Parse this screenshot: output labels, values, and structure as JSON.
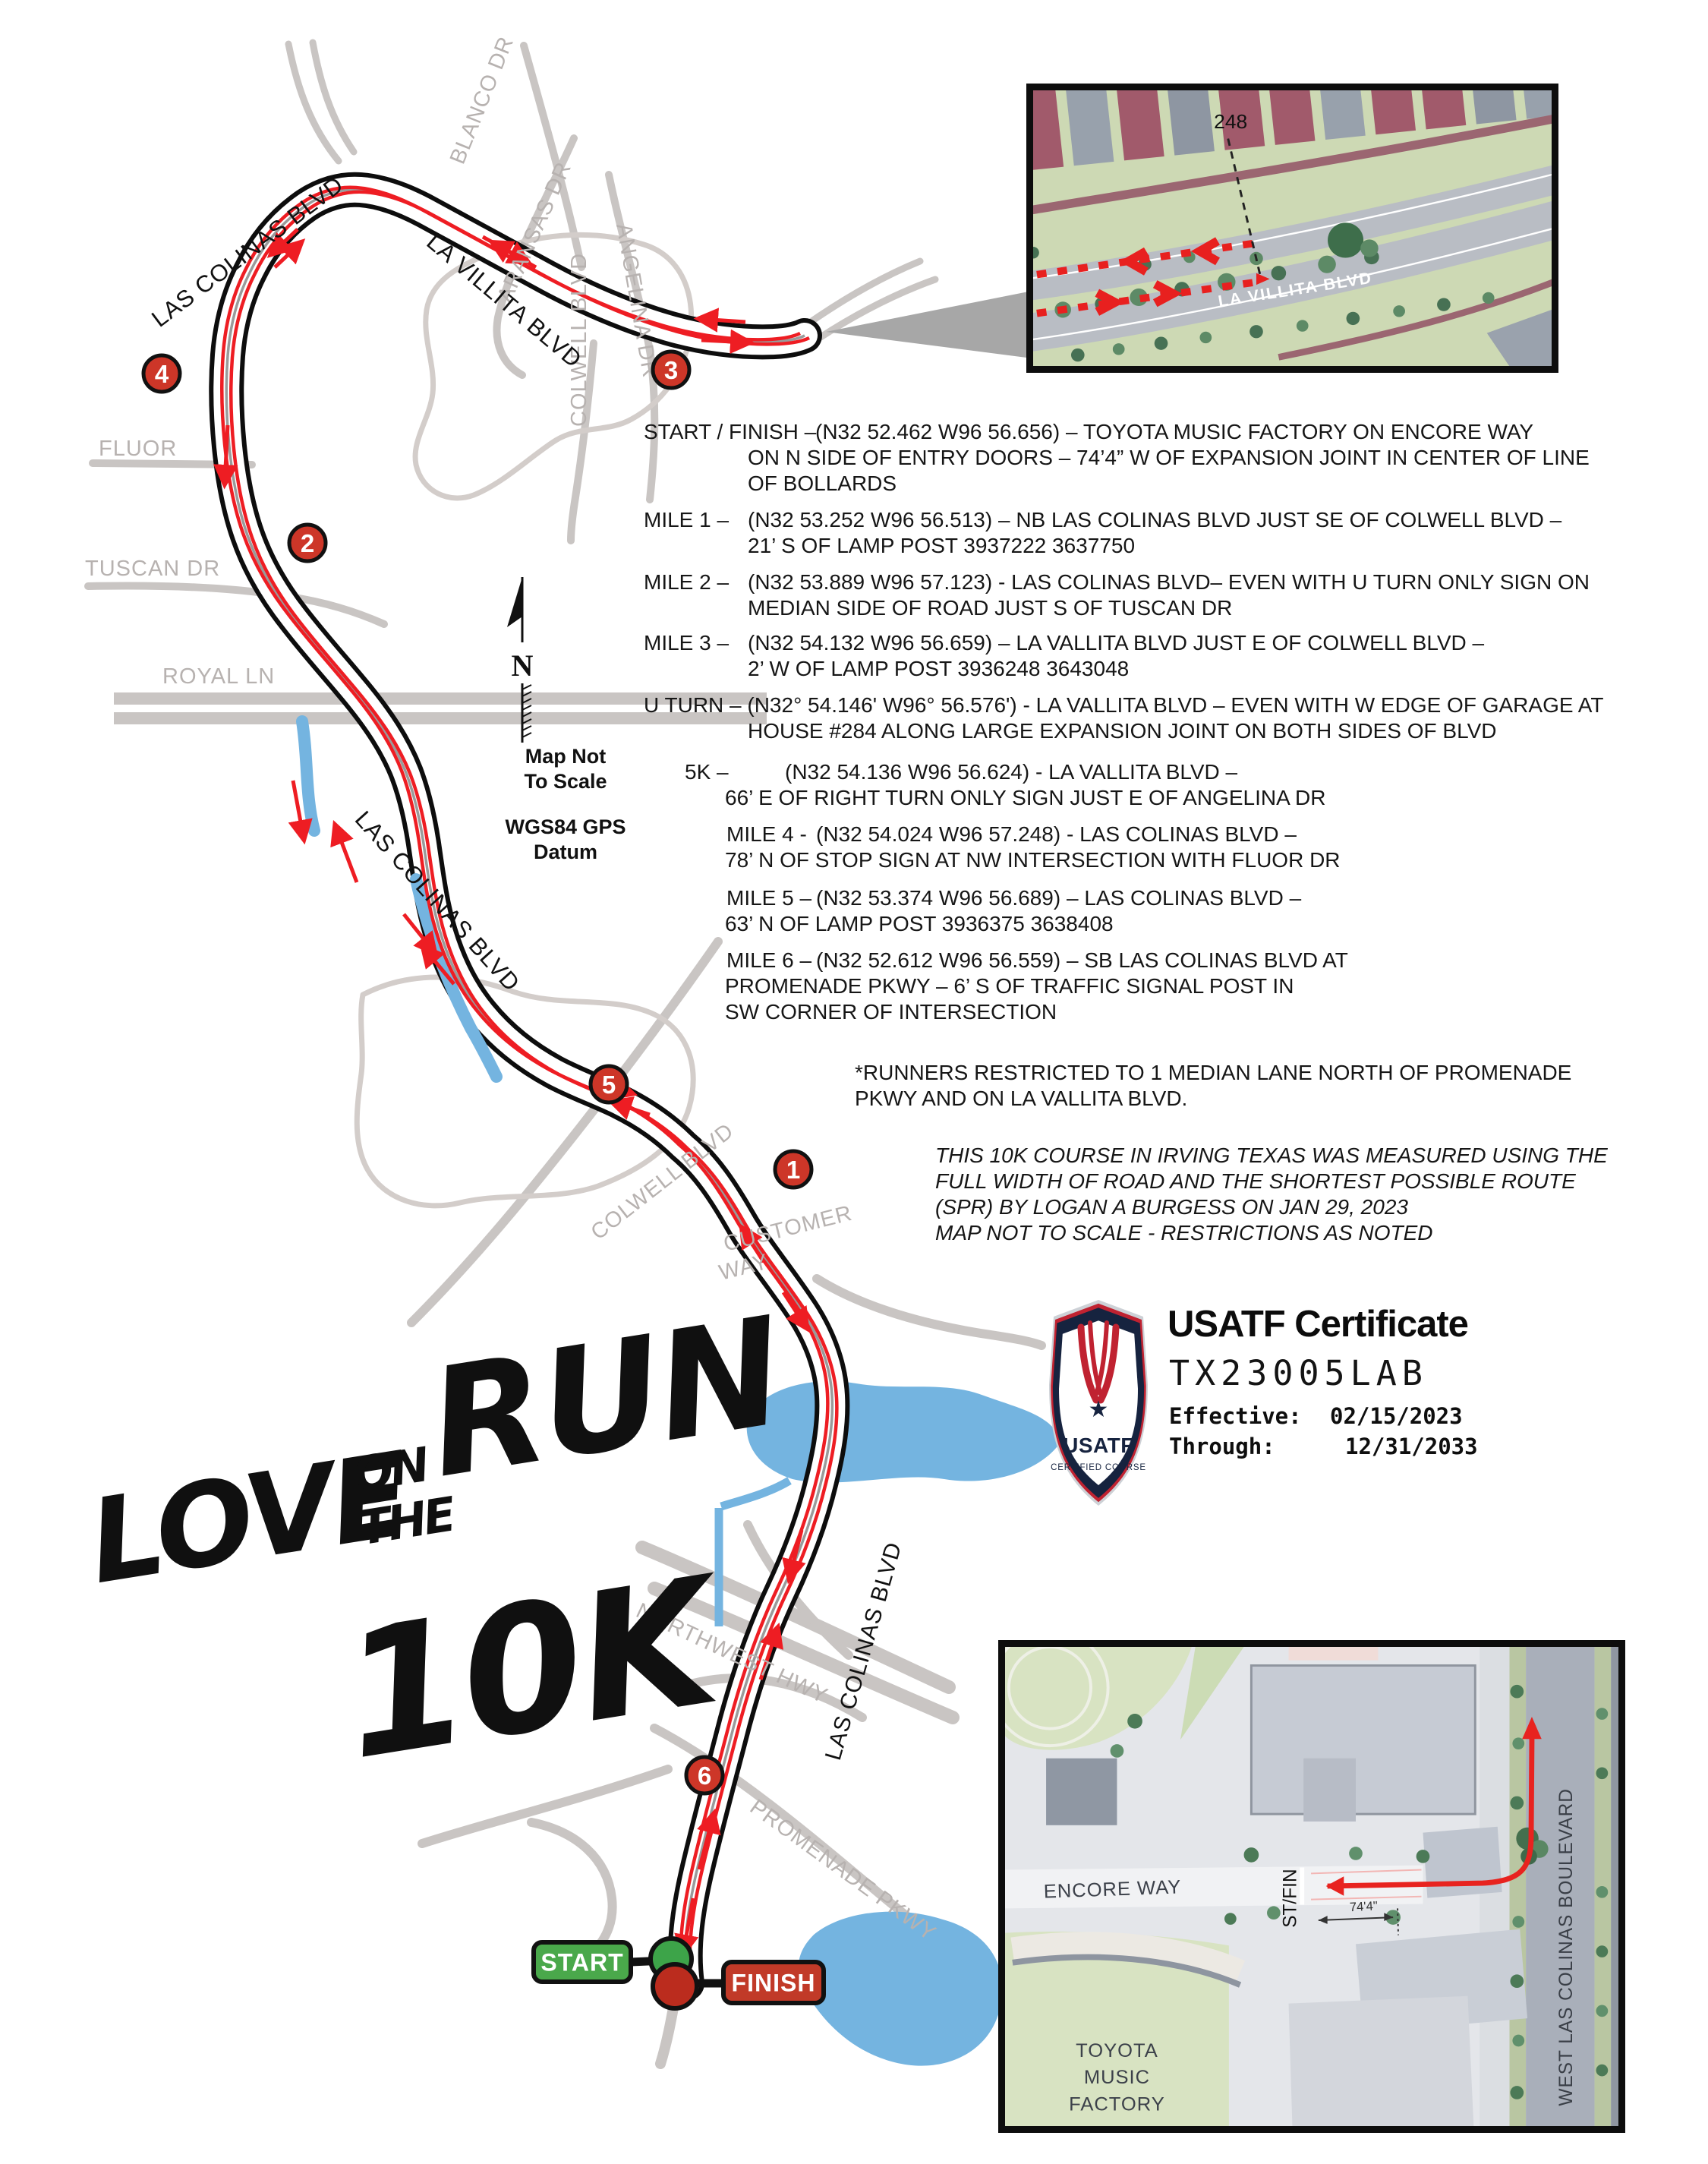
{
  "page": {
    "title": "Love on the Run 10K certified course map",
    "background": "#ffffff"
  },
  "logo": {
    "love": "LOVE",
    "on": "ON",
    "the": "THE",
    "run": "RUN",
    "tenk": "10K"
  },
  "north": {
    "n": "N",
    "scale1": "Map Not",
    "scale2": "To Scale",
    "datum1": "WGS84 GPS",
    "datum2": "Datum"
  },
  "map": {
    "colors": {
      "course_outline": "#0d0d0d",
      "course_fill": "#ffffff",
      "route_red": "#ee1d23",
      "minor_road_gray": "#c9c5c3",
      "label_gray": "#b7b2b0",
      "water_blue": "#74b4e0",
      "marker_red": "#cd3628",
      "start_green": "#4aa84b",
      "finish_red": "#c13a28"
    },
    "street_labels": {
      "blanco": "BLANCO DR",
      "aransas": "ARANSAS DR",
      "angelina": "ANGELINA DR",
      "la_villita": "LA VILLITA BLVD",
      "las_colinas_top": "LAS COLINAS BLVD",
      "colwell_top": "COLWELL BLVD",
      "fluor": "FLUOR",
      "tuscan": "TUSCAN DR",
      "royal": "ROYAL LN",
      "las_colinas_mid": "LAS COLINAS BLVD",
      "colwell_mid": "COLWELL BLVD",
      "customer1": "CUSTOMER",
      "customer2": "WAY",
      "northwest": "NORTHWEST HWY",
      "las_colinas_bottom": "LAS COLINAS BLVD",
      "promenade": "PROMENADE PKWY"
    },
    "mile_markers": [
      {
        "label": "1"
      },
      {
        "label": "2"
      },
      {
        "label": "3"
      },
      {
        "label": "4"
      },
      {
        "label": "5"
      },
      {
        "label": "6"
      }
    ],
    "start_label": "START",
    "finish_label": "FINISH"
  },
  "notes": {
    "sf": {
      "label": "START / FINISH –",
      "l1": "(N32 52.462 W96 56.656) – TOYOTA MUSIC FACTORY ON ENCORE WAY",
      "l2": "ON N SIDE OF ENTRY DOORS – 74’4” W OF EXPANSION JOINT IN CENTER OF LINE",
      "l3": "OF BOLLARDS"
    },
    "m1": {
      "label": "MILE 1 –",
      "l1": "(N32 53.252 W96 56.513) – NB LAS COLINAS BLVD JUST SE OF COLWELL BLVD –",
      "l2": "21’ S OF LAMP POST 3937222 3637750"
    },
    "m2": {
      "label": "MILE 2 –",
      "l1": "(N32 53.889 W96 57.123) - LAS COLINAS BLVD– EVEN WITH U TURN ONLY SIGN ON",
      "l2": "MEDIAN SIDE OF ROAD JUST S OF TUSCAN DR"
    },
    "m3": {
      "label": "MILE 3 –",
      "l1": "(N32 54.132 W96 56.659) – LA VALLITA BLVD JUST E OF COLWELL BLVD –",
      "l2": "2’ W OF LAMP POST 3936248 3643048"
    },
    "ut": {
      "l1": "U TURN – (N32° 54.146' W96° 56.576') - LA VALLITA BLVD – EVEN WITH W EDGE OF GARAGE AT",
      "l2": "HOUSE #284 ALONG LARGE EXPANSION JOINT ON BOTH SIDES OF BLVD"
    },
    "k5": {
      "label": "5K –",
      "l1": "(N32 54.136 W96 56.624) - LA VALLITA BLVD –",
      "l2": "66’ E OF RIGHT TURN ONLY SIGN JUST E OF ANGELINA DR"
    },
    "m4": {
      "label": "MILE 4 -",
      "l1": "(N32 54.024 W96 57.248) - LAS COLINAS BLVD –",
      "l2": "78’ N OF STOP SIGN AT NW INTERSECTION WITH FLUOR DR"
    },
    "m5": {
      "label": "MILE 5 –",
      "l1": "(N32 53.374 W96 56.689) – LAS COLINAS BLVD –",
      "l2": "63’ N OF LAMP POST 3936375 3638408"
    },
    "m6": {
      "label": "MILE 6 –",
      "l1": "(N32 52.612 W96 56.559) – SB LAS COLINAS BLVD AT",
      "l2": "PROMENADE PKWY – 6’ S OF TRAFFIC SIGNAL POST IN",
      "l3": "SW CORNER OF INTERSECTION"
    },
    "runners": {
      "l1": "*RUNNERS RESTRICTED TO 1 MEDIAN LANE NORTH OF PROMENADE",
      "l2": "PKWY AND ON LA VALLITA BLVD."
    },
    "cert": {
      "l1": "THIS 10K COURSE IN IRVING TEXAS WAS MEASURED USING THE",
      "l2": "FULL WIDTH OF ROAD AND THE SHORTEST POSSIBLE ROUTE",
      "l3": "(SPR) BY LOGAN A BURGESS ON  JAN 29, 2023",
      "l4": "MAP NOT TO SCALE - RESTRICTIONS AS NOTED"
    }
  },
  "usatf": {
    "title": "USATF Certificate",
    "code": "TX23005LAB",
    "effective_label": "Effective:",
    "effective_value": "02/15/2023",
    "through_label": "Through:",
    "through_value": "12/31/2033",
    "shield": {
      "org": "USATF",
      "sub": "CERTIFIED COURSE",
      "star": "★"
    }
  },
  "inset_top": {
    "house_number": "248",
    "street": "LA VILLITA BLVD"
  },
  "inset_bottom": {
    "encore": "ENCORE WAY",
    "stfin": "ST/FIN",
    "dist": "74'4\"",
    "toyota1": "TOYOTA",
    "toyota2": "MUSIC",
    "toyota3": "FACTORY",
    "blvd": "WEST LAS COLINAS BOULEVARD"
  }
}
